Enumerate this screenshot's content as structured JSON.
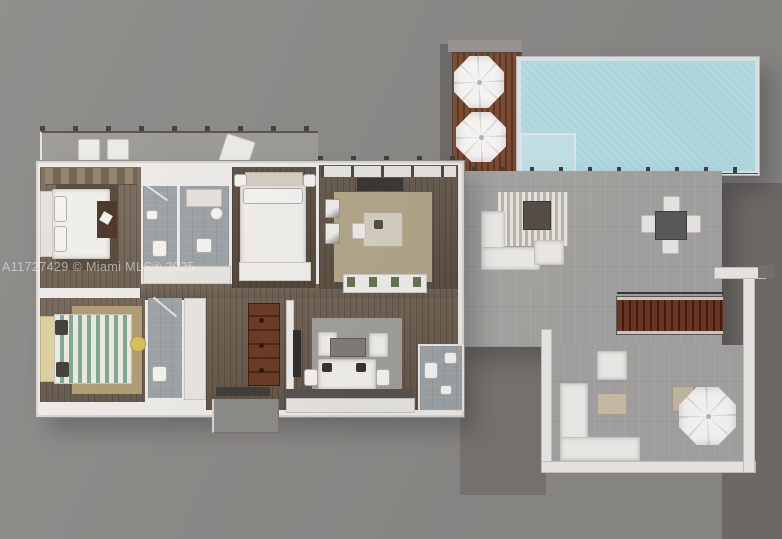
{
  "watermark": {
    "text": "A11727429 © Miami MLS® 2025"
  },
  "palette": {
    "bg": "#8d8b88",
    "bg-shadow": "#716e6b",
    "bg-notch": "#7a7773",
    "wall": "#efedea",
    "wall-edge": "#c9c6c1",
    "pool-water": "#b5dfe9",
    "pool-rim": "#e3eaec",
    "pool-steps": "#c8e7ee",
    "deck-a": "#7d4e34",
    "deck-b": "#63351f",
    "tile": "#a8a7a4",
    "bath-tile": "#9da3a6",
    "wood-master": "#776857",
    "wood-b2": "#584b3e",
    "wood-den": "#625547",
    "wood-corridor": "#6f6152",
    "wood-row2": "#6a5b4b",
    "wood-b3": "#6f6052",
    "soft-white": "#f3f1ed",
    "fixture": "#f6f5f2",
    "rug-dark": "#57493c",
    "rug-tan": "#b3a78a",
    "rug-tan2": "#b29c74",
    "rug-gray": "#a2a09b",
    "stripe-green": "#7fa892",
    "stripe-cream": "#ecebe4",
    "headboard-yellow": "#ded1a0",
    "stool-yellow": "#d9c35b",
    "stair-a": "#6f3826",
    "stair-b": "#42200f",
    "door-brown": "#6b3a24",
    "dark-furniture": "#4c3526",
    "tv-dark": "#2f2c29",
    "table-dark": "#5f5d5a",
    "table-beige": "#cec2ad",
    "umbrella": "#fcfbf9",
    "umbrella-rib": "#e3e0da",
    "railing": "#454341",
    "roof-tick": "#433f3b",
    "watermark": "rgba(245,244,242,0.55)"
  },
  "scene": {
    "type": "3d-floor-plan",
    "rooms": [
      "master-bedroom",
      "bathroom-1",
      "bathroom-2",
      "bedroom-2",
      "den",
      "bedroom-3",
      "bathroom-3",
      "foyer",
      "living-room",
      "powder-room",
      "upper-terrace",
      "lower-terrace",
      "pool-deck",
      "pool",
      "balcony"
    ],
    "objects": [
      "bed",
      "rug",
      "wardrobe",
      "dresser",
      "vanity",
      "toilet",
      "shower",
      "sofa",
      "armchair",
      "coffee-table",
      "dining-table",
      "dining-chairs",
      "tv",
      "desk",
      "planter",
      "staircase",
      "umbrellas",
      "window-sill",
      "entry-stoop",
      "fire-table"
    ]
  }
}
